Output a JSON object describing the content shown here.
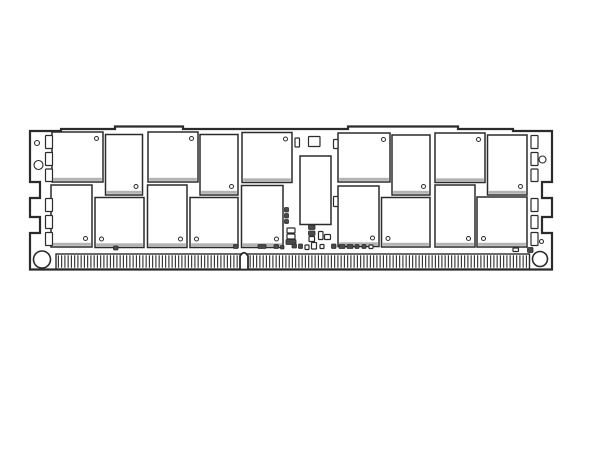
{
  "meta": {
    "figure_kind": "memory-module-line-drawing",
    "background_color": "#ffffff",
    "line_color": "#2b2b2b",
    "shadow_color": "#b3b3b3",
    "fill_color": "#ffffff",
    "component_fill": "#4a4a4a"
  },
  "module": {
    "outline_path": "M 30,269.5 L 30,233 L 40,233 L 40,217 L 30,217 L 30,198 L 40,198 L 40,182 L 30,182 L 30,131 L 61,131 L 61,129 L 115,129 L 115,126.5 L 183,126.5 L 183,129 L 348,129 L 348,126.5 L 458,126.5 L 458,129 L 513,129 L 513,131 L 552,131 L 552,182 L 542,182 L 542,198 L 552,198 L 552,217 L 542,217 L 542,233 L 552,233 L 552,269.5 Z",
    "connector": {
      "x1": 56,
      "x2": 529.5,
      "y1": 254,
      "y2": 269,
      "pin_spacing": 3.25,
      "pin_width": 1.1
    },
    "key_notch": {
      "x1": 240,
      "x2": 248,
      "top": 253,
      "bottom": 269.5
    },
    "mount_holes": [
      [
        42,
        259.5,
        8.5
      ],
      [
        540,
        259,
        7.5
      ]
    ],
    "board_circles": [
      [
        37,
        143,
        2.5
      ],
      [
        38.5,
        165,
        4.5
      ],
      [
        542.5,
        159.5,
        3.5
      ],
      [
        541.5,
        241.5,
        2
      ]
    ],
    "register_chip": [
      300,
      156,
      31,
      68.5
    ],
    "dram_chips": [
      [
        52,
        132,
        51,
        50,
        "tr"
      ],
      [
        105.5,
        134.5,
        37,
        60.5,
        "br"
      ],
      [
        148,
        132,
        50,
        50,
        "tr"
      ],
      [
        200,
        134.5,
        38,
        60.5,
        "br"
      ],
      [
        242,
        132.5,
        50,
        50,
        "tr"
      ],
      [
        338,
        133,
        52,
        49,
        "tr"
      ],
      [
        392,
        135,
        38,
        60,
        "br"
      ],
      [
        435,
        133,
        50,
        49.5,
        "tr"
      ],
      [
        487.5,
        135,
        39.5,
        60,
        "br"
      ],
      [
        51,
        185,
        41,
        62,
        "br"
      ],
      [
        95,
        197.5,
        49,
        50,
        "bl"
      ],
      [
        147.5,
        185,
        39.5,
        62.5,
        "br"
      ],
      [
        190,
        197.5,
        48,
        50,
        "bl"
      ],
      [
        241.5,
        185.5,
        41.5,
        62,
        "br"
      ],
      [
        338,
        186,
        41,
        60.5,
        "br"
      ],
      [
        381.5,
        197.5,
        48.5,
        49.5,
        "bl"
      ],
      [
        435,
        185,
        40,
        62,
        "br"
      ],
      [
        477,
        197,
        50,
        50,
        "bl"
      ]
    ],
    "passive_components": [
      [
        45.5,
        135.5,
        7,
        13,
        "o"
      ],
      [
        45.5,
        152.5,
        7,
        13,
        "o"
      ],
      [
        45.5,
        169,
        7,
        12.5,
        "o"
      ],
      [
        45.5,
        198.5,
        7,
        13,
        "o"
      ],
      [
        45.5,
        215.5,
        7,
        13,
        "o"
      ],
      [
        45.5,
        232.5,
        7,
        13,
        "o"
      ],
      [
        531,
        135.5,
        7,
        13,
        "o"
      ],
      [
        531,
        152.5,
        7,
        13,
        "o"
      ],
      [
        531,
        169,
        7,
        12.5,
        "o"
      ],
      [
        531,
        198.5,
        7,
        13,
        "o"
      ],
      [
        531,
        215.5,
        7,
        13,
        "o"
      ],
      [
        531,
        232.5,
        7,
        13,
        "o"
      ],
      [
        295,
        138,
        4.5,
        9,
        "o"
      ],
      [
        308.5,
        136.5,
        11.5,
        10,
        "o"
      ],
      [
        333.5,
        139.5,
        4.5,
        9,
        "o"
      ],
      [
        333.5,
        196.5,
        4.5,
        10,
        "o"
      ],
      [
        284.5,
        207.5,
        4,
        4.5,
        "f"
      ],
      [
        284.5,
        213.5,
        4,
        4.5,
        "f"
      ],
      [
        284.5,
        219.5,
        4,
        4,
        "f"
      ],
      [
        287,
        228,
        8,
        5,
        "o"
      ],
      [
        287,
        234,
        8,
        5,
        "o"
      ],
      [
        286,
        239.5,
        10,
        5,
        "f"
      ],
      [
        308.5,
        225,
        6.5,
        4.5,
        "f"
      ],
      [
        308.5,
        231,
        6.5,
        4.5,
        "f"
      ],
      [
        309,
        236.5,
        5.5,
        5,
        "o"
      ],
      [
        318.5,
        231.5,
        4.5,
        8,
        "o"
      ],
      [
        324.5,
        234.5,
        6,
        5,
        "o"
      ],
      [
        113.5,
        246,
        4.5,
        4,
        "f"
      ],
      [
        233.5,
        244.5,
        4.5,
        4,
        "f"
      ],
      [
        258,
        244.5,
        8,
        4,
        "f"
      ],
      [
        274,
        244.5,
        4.5,
        4,
        "f"
      ],
      [
        280.5,
        245.5,
        3.5,
        3.5,
        "f"
      ],
      [
        292,
        244,
        4.5,
        4,
        "f"
      ],
      [
        298.5,
        244,
        4,
        4.5,
        "f"
      ],
      [
        305,
        245,
        4,
        4.5,
        "o"
      ],
      [
        311.5,
        242.5,
        5,
        6.5,
        "o"
      ],
      [
        320,
        244.5,
        4,
        4,
        "o"
      ],
      [
        331.5,
        244,
        4.5,
        4.5,
        "f"
      ],
      [
        339,
        244.5,
        6,
        4,
        "f"
      ],
      [
        347,
        244.5,
        6,
        4,
        "f"
      ],
      [
        355,
        244.5,
        4,
        4,
        "f"
      ],
      [
        362,
        244.5,
        4,
        4,
        "f"
      ],
      [
        369,
        245,
        4,
        3.5,
        "o"
      ],
      [
        513,
        248,
        5.5,
        3.5,
        "o"
      ],
      [
        527.5,
        247.5,
        5.5,
        5,
        "f"
      ]
    ]
  }
}
